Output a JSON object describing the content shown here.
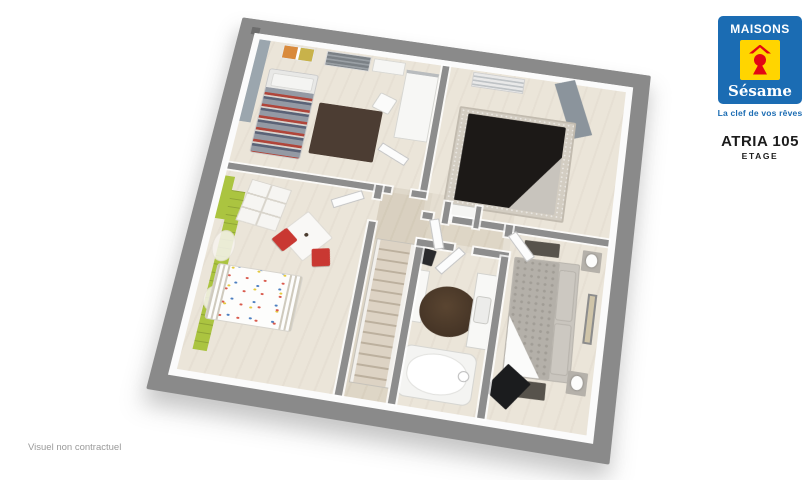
{
  "branding": {
    "name_top": "MAISONS",
    "name_script": "Sésame",
    "tagline": "La clef de vos rêves",
    "logo_icon": "keyhole-under-roof"
  },
  "plan": {
    "model": "ATRIA 105",
    "level": "ETAGE",
    "view": "3d-floorplan-upper-floor"
  },
  "footer": {
    "disclaimer": "Visuel non contractuel"
  },
  "colors": {
    "logo-blue": "#1b6cb3",
    "logo-yellow": "#ffd500",
    "logo-red": "#e30613",
    "frame-gray": "#8a8a8a",
    "wall-white": "#fbfbfb",
    "floor-beige": "#e4dccd",
    "accent-bluegray": "#9ba6ae",
    "accent-graystripe": "#8b949c",
    "accent-green": "#abc440",
    "accent-red": "#c93832",
    "rug-brown": "#4c3d33",
    "rug-dark": "#57534c",
    "bed-dark": "#1c1917",
    "carpet-gray": "#d3cdc2",
    "duvet-gray": "#b4b0a9",
    "text-gray": "#9a9a9a"
  }
}
